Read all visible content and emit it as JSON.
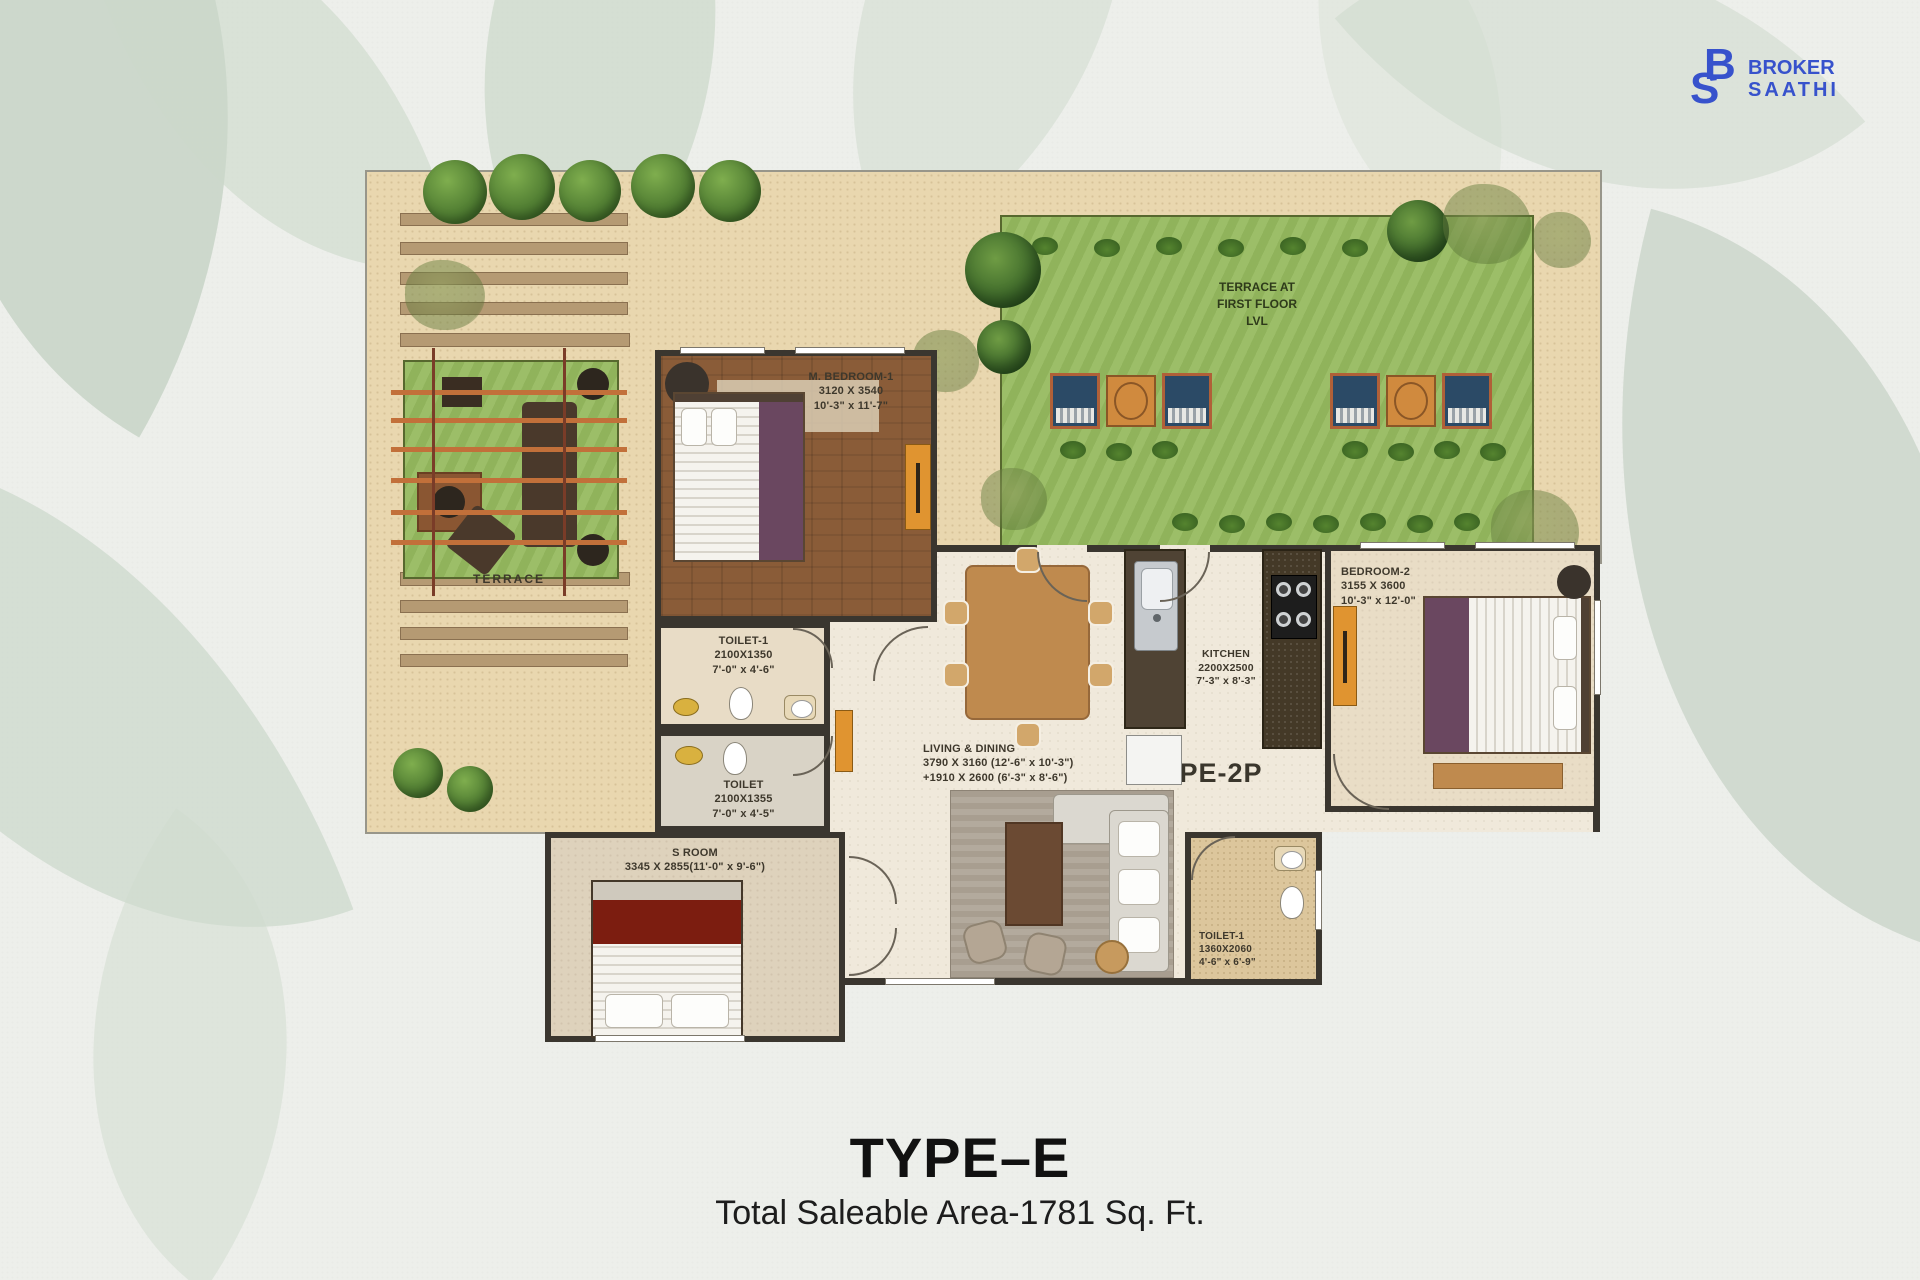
{
  "logo": {
    "mono_b": "B",
    "mono_s": "S",
    "word1": "BROKER",
    "word2": "SAATHI"
  },
  "footer": {
    "title": "TYPE–E",
    "subtitle": "Total Saleable Area-1781 Sq. Ft."
  },
  "plan": {
    "unit_type": "TYPE-2P",
    "terrace_label": "TERRACE",
    "lawn_label": {
      "l1": "TERRACE AT",
      "l2": "FIRST FLOOR",
      "l3": "LVL"
    },
    "rooms": {
      "m_bedroom1": {
        "name": "M. BEDROOM-1",
        "mm": "3120 X 3540",
        "ft": "10'-3\" x 11'-7\""
      },
      "toilet1_top": {
        "name": "TOILET-1",
        "mm": "2100X1350",
        "ft": "7'-0\" x 4'-6\""
      },
      "toilet_mid": {
        "name": "TOILET",
        "mm": "2100X1355",
        "ft": "7'-0\" x 4'-5\""
      },
      "s_room": {
        "name": "S ROOM",
        "dim": "3345 X 2855(11'-0\" x 9'-6\")"
      },
      "living": {
        "name": "LIVING & DINING",
        "dim1": "3790 X 3160 (12'-6\" x 10'-3\")",
        "dim2": "+1910 X 2600 (6'-3\" x 8'-6\")"
      },
      "kitchen": {
        "name": "KITCHEN",
        "mm": "2200X2500",
        "ft": "7'-3\" x 8'-3\""
      },
      "bedroom2": {
        "name": "BEDROOM-2",
        "mm": "3155 X 3600",
        "ft": "10'-3\" x 12'-0\""
      },
      "toilet1_br": {
        "name": "TOILET-1",
        "mm": "1360X2060",
        "ft": "4'-6\" x 6'-9\""
      }
    }
  },
  "colors": {
    "brand_blue": "#3752cc",
    "sand": "#e9d7af",
    "lawn_green": "#96ba5f",
    "wall": "#3a362f",
    "wood_floor": "#8a5c38",
    "accent_orange": "#e09430",
    "bed_purple": "#6a4760",
    "bed_maroon": "#7c1d10"
  }
}
